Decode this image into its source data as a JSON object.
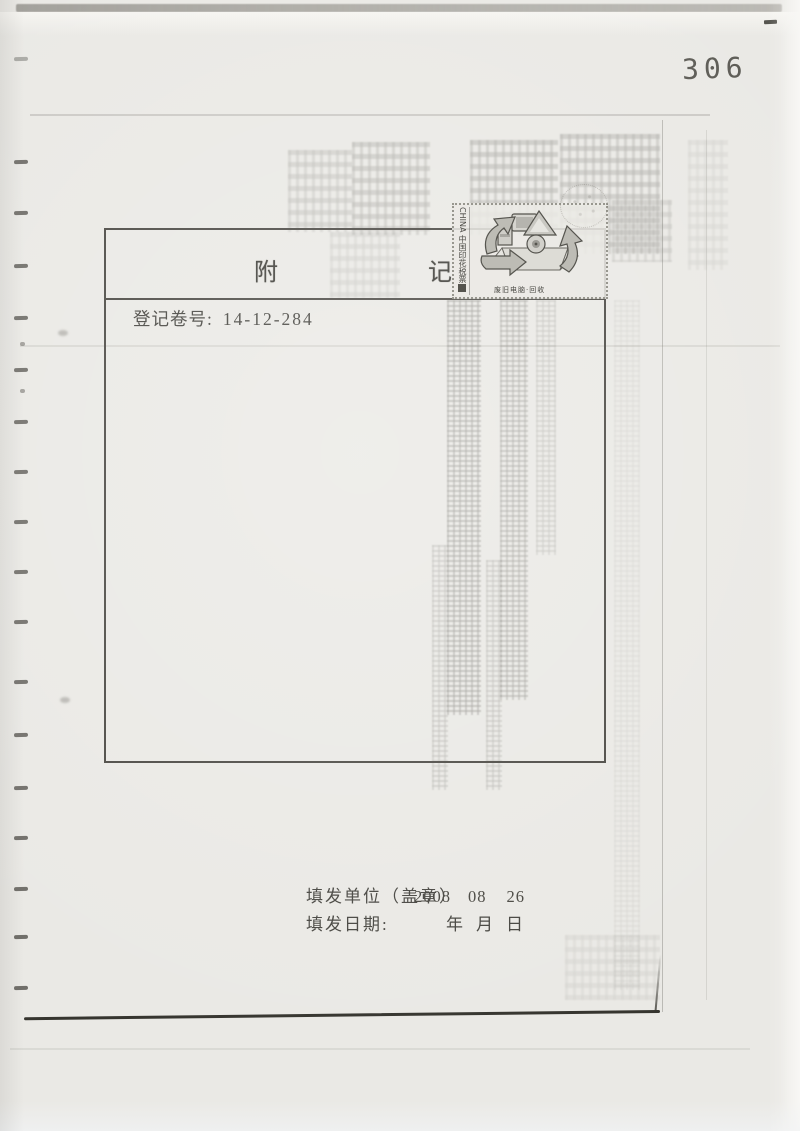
{
  "page": {
    "page_number": "306"
  },
  "colors": {
    "paper": "#eae9e5",
    "ink": "#44433e",
    "box_border": "#4a4843"
  },
  "box": {
    "title_left": "附",
    "title_right": "记",
    "registration_label": "登记卷号:",
    "registration_number": "14-12-284"
  },
  "stamp": {
    "country_label": "CHINA 中国印花税票",
    "caption": "废旧电脑·回收"
  },
  "footer": {
    "unit_label": "填发单位（盖章）",
    "date_label": "填发日期:",
    "stamp_date": {
      "year": "2008",
      "month": "08",
      "day": "26"
    },
    "units": {
      "year": "年",
      "month": "月",
      "day": "日"
    }
  }
}
